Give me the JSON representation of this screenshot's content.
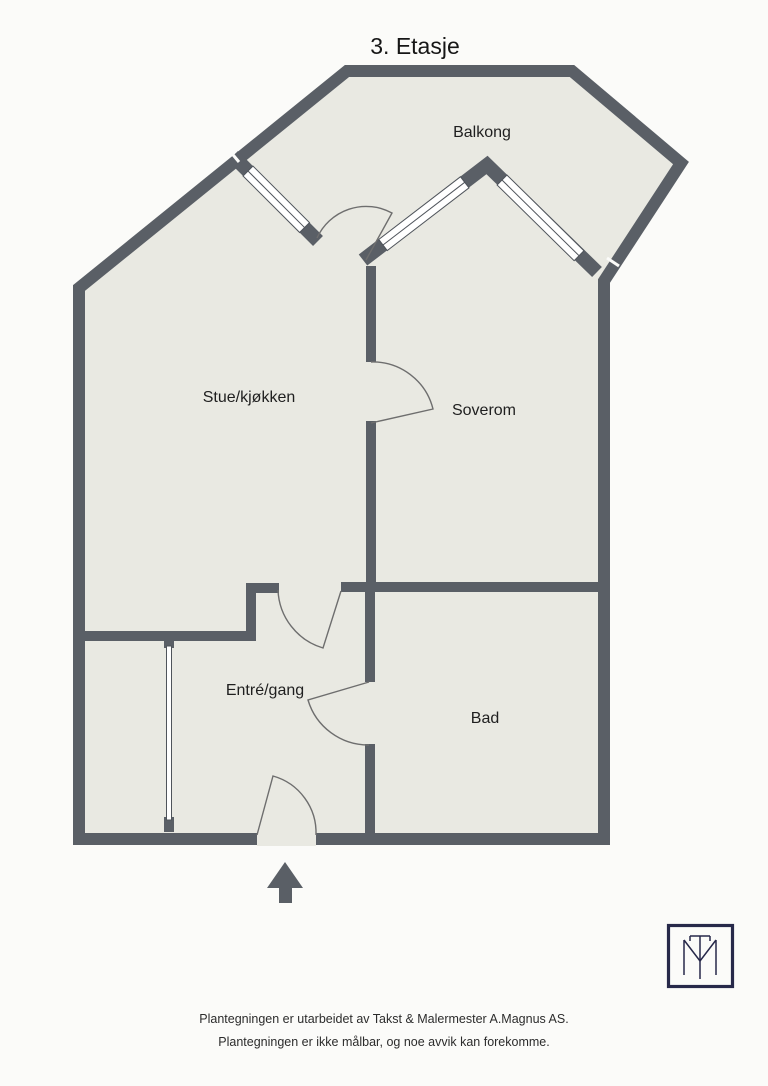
{
  "title": "3. Etasje",
  "rooms": {
    "balkong": "Balkong",
    "stue": "Stue/kjøkken",
    "soverom": "Soverom",
    "entre": "Entré/gang",
    "bad": "Bad"
  },
  "footer": {
    "line1": "Plantegningen er utarbeidet av Takst & Malermester A.Magnus AS.",
    "line2": "Plantegningen er ikke målbar, og noe avvik kan forekomme."
  },
  "colors": {
    "wall": "#5a5f66",
    "floor": "#e9e9e2",
    "background": "#fbfbf9",
    "logo_navy": "#27294a"
  }
}
